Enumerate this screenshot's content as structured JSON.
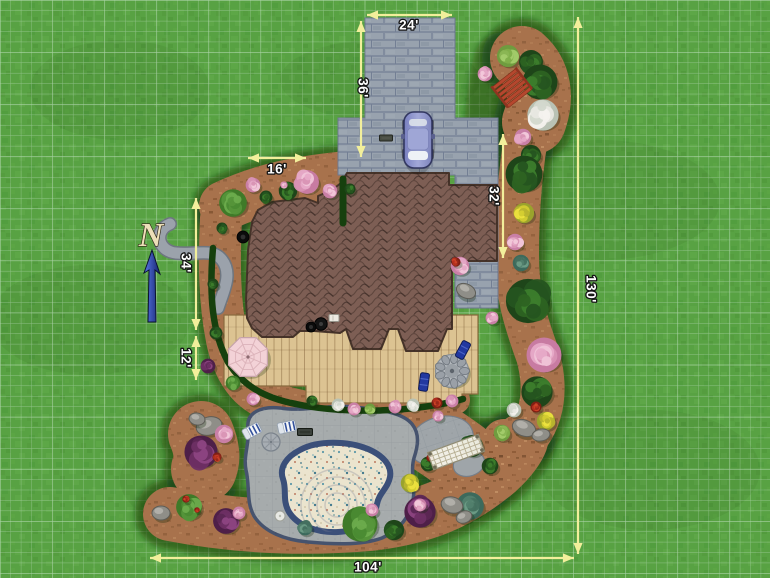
{
  "meta": {
    "view": "landscape-plan-top-down"
  },
  "north": {
    "label": "N"
  },
  "dimensions": [
    {
      "id": "driveway-width",
      "label": "24'",
      "x1": 367,
      "y1": 15,
      "x2": 452,
      "y2": 15,
      "lx": 409,
      "ly": 26,
      "vertical": false
    },
    {
      "id": "driveway-length",
      "label": "36'",
      "x1": 361,
      "y1": 21,
      "x2": 361,
      "y2": 157,
      "lx": 362,
      "ly": 88,
      "vertical": true
    },
    {
      "id": "front-bed-width",
      "label": "16'",
      "x1": 248,
      "y1": 158,
      "x2": 306,
      "y2": 158,
      "lx": 277,
      "ly": 170,
      "vertical": false
    },
    {
      "id": "right-wing-depth",
      "label": "32'",
      "x1": 503,
      "y1": 134,
      "x2": 503,
      "y2": 258,
      "lx": 493,
      "ly": 196,
      "vertical": true
    },
    {
      "id": "left-side-upper",
      "label": "34'",
      "x1": 196,
      "y1": 198,
      "x2": 196,
      "y2": 330,
      "lx": 185,
      "ly": 263,
      "vertical": true
    },
    {
      "id": "left-side-lower",
      "label": "12'",
      "x1": 196,
      "y1": 336,
      "x2": 196,
      "y2": 380,
      "lx": 185,
      "ly": 358,
      "vertical": true
    },
    {
      "id": "property-height",
      "label": "130'",
      "x1": 578,
      "y1": 17,
      "x2": 578,
      "y2": 554,
      "lx": 590,
      "ly": 289,
      "vertical": true
    },
    {
      "id": "property-width",
      "label": "104'",
      "x1": 150,
      "y1": 558,
      "x2": 574,
      "y2": 558,
      "lx": 368,
      "ly": 568,
      "vertical": false
    }
  ],
  "colors": {
    "grass": "#58a243",
    "grid": "rgba(228,246,240,0.40)",
    "mulch": "#a8724c",
    "bed_shadow": "rgba(16,52,10,0.55)",
    "hedge": "#16400e",
    "driveway": "#98a2ae",
    "roof": "#7d5e54",
    "deck": "#dcc392",
    "pool_deck": "#a6abac",
    "pool_border": "#46536e",
    "pool_coping": "#3b4f79",
    "pool_water": "#ebe4ce",
    "dimension": "#f2ef9b",
    "dim_text": "#ffffff",
    "north_letter": "#ecdfb8",
    "north_arrow": "#1b2f86",
    "car": "#8f96cc",
    "stone_path": "#9ba2ab",
    "rock": "#8f8e88",
    "trellis": "#f6f3e9",
    "bench": "#b5472e",
    "umbrella": "#f3d2d7",
    "lounge": "#f4f6f8",
    "deck_chair": "#2238a0"
  },
  "plants": [
    {
      "t": "flower-pink",
      "x": 485,
      "y": 74,
      "r": 8
    },
    {
      "t": "shrub-light",
      "x": 508,
      "y": 56,
      "r": 12
    },
    {
      "t": "tree-dark",
      "x": 531,
      "y": 62,
      "r": 13
    },
    {
      "t": "tree-dark",
      "x": 540,
      "y": 82,
      "r": 19
    },
    {
      "t": "flower-white",
      "x": 543,
      "y": 115,
      "r": 17
    },
    {
      "t": "flower-pink",
      "x": 523,
      "y": 137,
      "r": 9
    },
    {
      "t": "tree-dark",
      "x": 531,
      "y": 155,
      "r": 11
    },
    {
      "t": "tree-dark",
      "x": 524,
      "y": 174,
      "r": 20
    },
    {
      "t": "flower-yellow",
      "x": 524,
      "y": 213,
      "r": 11
    },
    {
      "t": "flower-pink",
      "x": 515,
      "y": 242,
      "r": 9
    },
    {
      "t": "bush-teal",
      "x": 521,
      "y": 263,
      "r": 9
    },
    {
      "t": "tree-dark",
      "x": 528,
      "y": 301,
      "r": 24
    },
    {
      "t": "tree-pink",
      "x": 544,
      "y": 355,
      "r": 19
    },
    {
      "t": "tree-dark",
      "x": 537,
      "y": 392,
      "r": 17
    },
    {
      "t": "flower-white",
      "x": 514,
      "y": 410,
      "r": 8
    },
    {
      "t": "flower-red",
      "x": 536,
      "y": 407,
      "r": 6
    },
    {
      "t": "flower-yellow",
      "x": 546,
      "y": 421,
      "r": 10
    },
    {
      "t": "rock",
      "x": 524,
      "y": 428,
      "rx": 12,
      "ry": 8,
      "rot": 20
    },
    {
      "t": "rock",
      "x": 541,
      "y": 435,
      "rx": 9,
      "ry": 6,
      "rot": -10
    },
    {
      "t": "shrub-light",
      "x": 502,
      "y": 433,
      "r": 9
    },
    {
      "t": "tree-dark",
      "x": 472,
      "y": 446,
      "r": 12
    },
    {
      "t": "tree-dark",
      "x": 490,
      "y": 466,
      "r": 9
    },
    {
      "t": "tree-dark",
      "x": 428,
      "y": 464,
      "r": 8
    },
    {
      "t": "flower-red",
      "x": 430,
      "y": 458,
      "r": 4
    },
    {
      "t": "flower-yellow",
      "x": 410,
      "y": 483,
      "r": 10
    },
    {
      "t": "bush-purple",
      "x": 420,
      "y": 512,
      "r": 17
    },
    {
      "t": "bush-teal",
      "x": 470,
      "y": 506,
      "r": 15
    },
    {
      "t": "rock",
      "x": 452,
      "y": 505,
      "rx": 11,
      "ry": 8,
      "rot": 15
    },
    {
      "t": "rock",
      "x": 464,
      "y": 517,
      "rx": 8,
      "ry": 6,
      "rot": -20
    },
    {
      "t": "flower-pink",
      "x": 438,
      "y": 416,
      "r": 6
    },
    {
      "t": "rock",
      "x": 209,
      "y": 426,
      "rx": 13,
      "ry": 9,
      "rot": -15
    },
    {
      "t": "rock",
      "x": 197,
      "y": 419,
      "rx": 8,
      "ry": 6,
      "rot": 10
    },
    {
      "t": "flower-pink",
      "x": 224,
      "y": 434,
      "r": 10
    },
    {
      "t": "bush-purple",
      "x": 201,
      "y": 452,
      "r": 18
    },
    {
      "t": "flower-red",
      "x": 217,
      "y": 457,
      "r": 5
    },
    {
      "t": "rock",
      "x": 161,
      "y": 513,
      "rx": 9,
      "ry": 7,
      "rot": 0
    },
    {
      "t": "tree-green",
      "x": 189,
      "y": 507,
      "r": 14
    },
    {
      "t": "flower-red",
      "x": 186,
      "y": 499,
      "r": 4
    },
    {
      "t": "flower-red",
      "x": 197,
      "y": 510,
      "r": 3
    },
    {
      "t": "bush-purple",
      "x": 226,
      "y": 521,
      "r": 14
    },
    {
      "t": "flower-pink",
      "x": 239,
      "y": 513,
      "r": 7
    },
    {
      "t": "bush-teal",
      "x": 305,
      "y": 528,
      "r": 8
    },
    {
      "t": "tree-green",
      "x": 360,
      "y": 524,
      "r": 19
    },
    {
      "t": "flower-pink",
      "x": 372,
      "y": 510,
      "r": 7
    },
    {
      "t": "tree-dark",
      "x": 394,
      "y": 530,
      "r": 11
    },
    {
      "t": "flower-pink",
      "x": 420,
      "y": 505,
      "r": 7
    },
    {
      "t": "tree-dark",
      "x": 312,
      "y": 401,
      "r": 6
    },
    {
      "t": "flower-white",
      "x": 338,
      "y": 405,
      "r": 7
    },
    {
      "t": "flower-pink",
      "x": 354,
      "y": 409,
      "r": 7
    },
    {
      "t": "shrub-light",
      "x": 370,
      "y": 409,
      "r": 6
    },
    {
      "t": "flower-pink",
      "x": 395,
      "y": 407,
      "r": 7
    },
    {
      "t": "flower-white",
      "x": 413,
      "y": 405,
      "r": 7
    },
    {
      "t": "flower-red",
      "x": 437,
      "y": 403,
      "r": 6
    },
    {
      "t": "flower-pink",
      "x": 452,
      "y": 401,
      "r": 7
    },
    {
      "t": "tree-green",
      "x": 233,
      "y": 203,
      "r": 15
    },
    {
      "t": "flower-pink",
      "x": 253,
      "y": 185,
      "r": 8
    },
    {
      "t": "tree-dark",
      "x": 266,
      "y": 197,
      "r": 7
    },
    {
      "t": "tree-dark",
      "x": 288,
      "y": 191,
      "r": 10
    },
    {
      "t": "flower-pink",
      "x": 284,
      "y": 185,
      "r": 4
    },
    {
      "t": "tree-pink",
      "x": 307,
      "y": 182,
      "r": 13
    },
    {
      "t": "flower-pink",
      "x": 330,
      "y": 191,
      "r": 8
    },
    {
      "t": "tree-dark",
      "x": 350,
      "y": 189,
      "r": 6
    },
    {
      "t": "tree-dark",
      "x": 222,
      "y": 228,
      "r": 6
    },
    {
      "t": "tree-dark",
      "x": 213,
      "y": 284,
      "r": 6
    },
    {
      "t": "tree-dark",
      "x": 216,
      "y": 333,
      "r": 7
    },
    {
      "t": "bush-purple",
      "x": 208,
      "y": 366,
      "r": 8
    },
    {
      "t": "tree-green",
      "x": 233,
      "y": 383,
      "r": 8
    },
    {
      "t": "flower-pink",
      "x": 253,
      "y": 399,
      "r": 7
    },
    {
      "t": "flower-pink",
      "x": 460,
      "y": 266,
      "r": 10
    },
    {
      "t": "flower-red",
      "x": 456,
      "y": 262,
      "r": 5
    },
    {
      "t": "rock",
      "x": 466,
      "y": 291,
      "rx": 10,
      "ry": 7,
      "rot": 25
    },
    {
      "t": "flower-pink",
      "x": 492,
      "y": 318,
      "r": 7
    }
  ],
  "furniture": [
    {
      "kind": "bench",
      "x": 512,
      "y": 88,
      "rot": -38
    },
    {
      "kind": "lounge-white",
      "x": 252,
      "y": 431,
      "rot": -28
    },
    {
      "kind": "lounge-white",
      "x": 287,
      "y": 427,
      "rot": -12
    },
    {
      "kind": "round-paver",
      "x": 271,
      "y": 442,
      "r": 9
    },
    {
      "kind": "mat",
      "x": 305,
      "y": 432,
      "w": 15,
      "h": 7
    },
    {
      "kind": "side-table",
      "x": 280,
      "y": 516,
      "r": 5
    },
    {
      "kind": "umbrella-table",
      "x": 248,
      "y": 357,
      "r": 21
    },
    {
      "kind": "fire-pit",
      "x": 452,
      "y": 371,
      "r": 16
    },
    {
      "kind": "deck-chair",
      "x": 463,
      "y": 350,
      "rot": 28
    },
    {
      "kind": "deck-chair",
      "x": 424,
      "y": 382,
      "rot": 8
    },
    {
      "kind": "trellis",
      "x": 456,
      "y": 452,
      "rot": -20,
      "w": 54,
      "h": 18
    },
    {
      "kind": "grill",
      "x": 321,
      "y": 324
    },
    {
      "kind": "utility-box",
      "x": 334,
      "y": 318,
      "w": 10,
      "h": 7
    },
    {
      "kind": "door-mat",
      "x": 386,
      "y": 138,
      "w": 13,
      "h": 6
    },
    {
      "kind": "chimney",
      "x": 243,
      "y": 237,
      "r": 6
    },
    {
      "kind": "chimney",
      "x": 311,
      "y": 327,
      "r": 5
    },
    {
      "kind": "car",
      "x": 418,
      "y": 140,
      "w": 28,
      "h": 56
    }
  ]
}
